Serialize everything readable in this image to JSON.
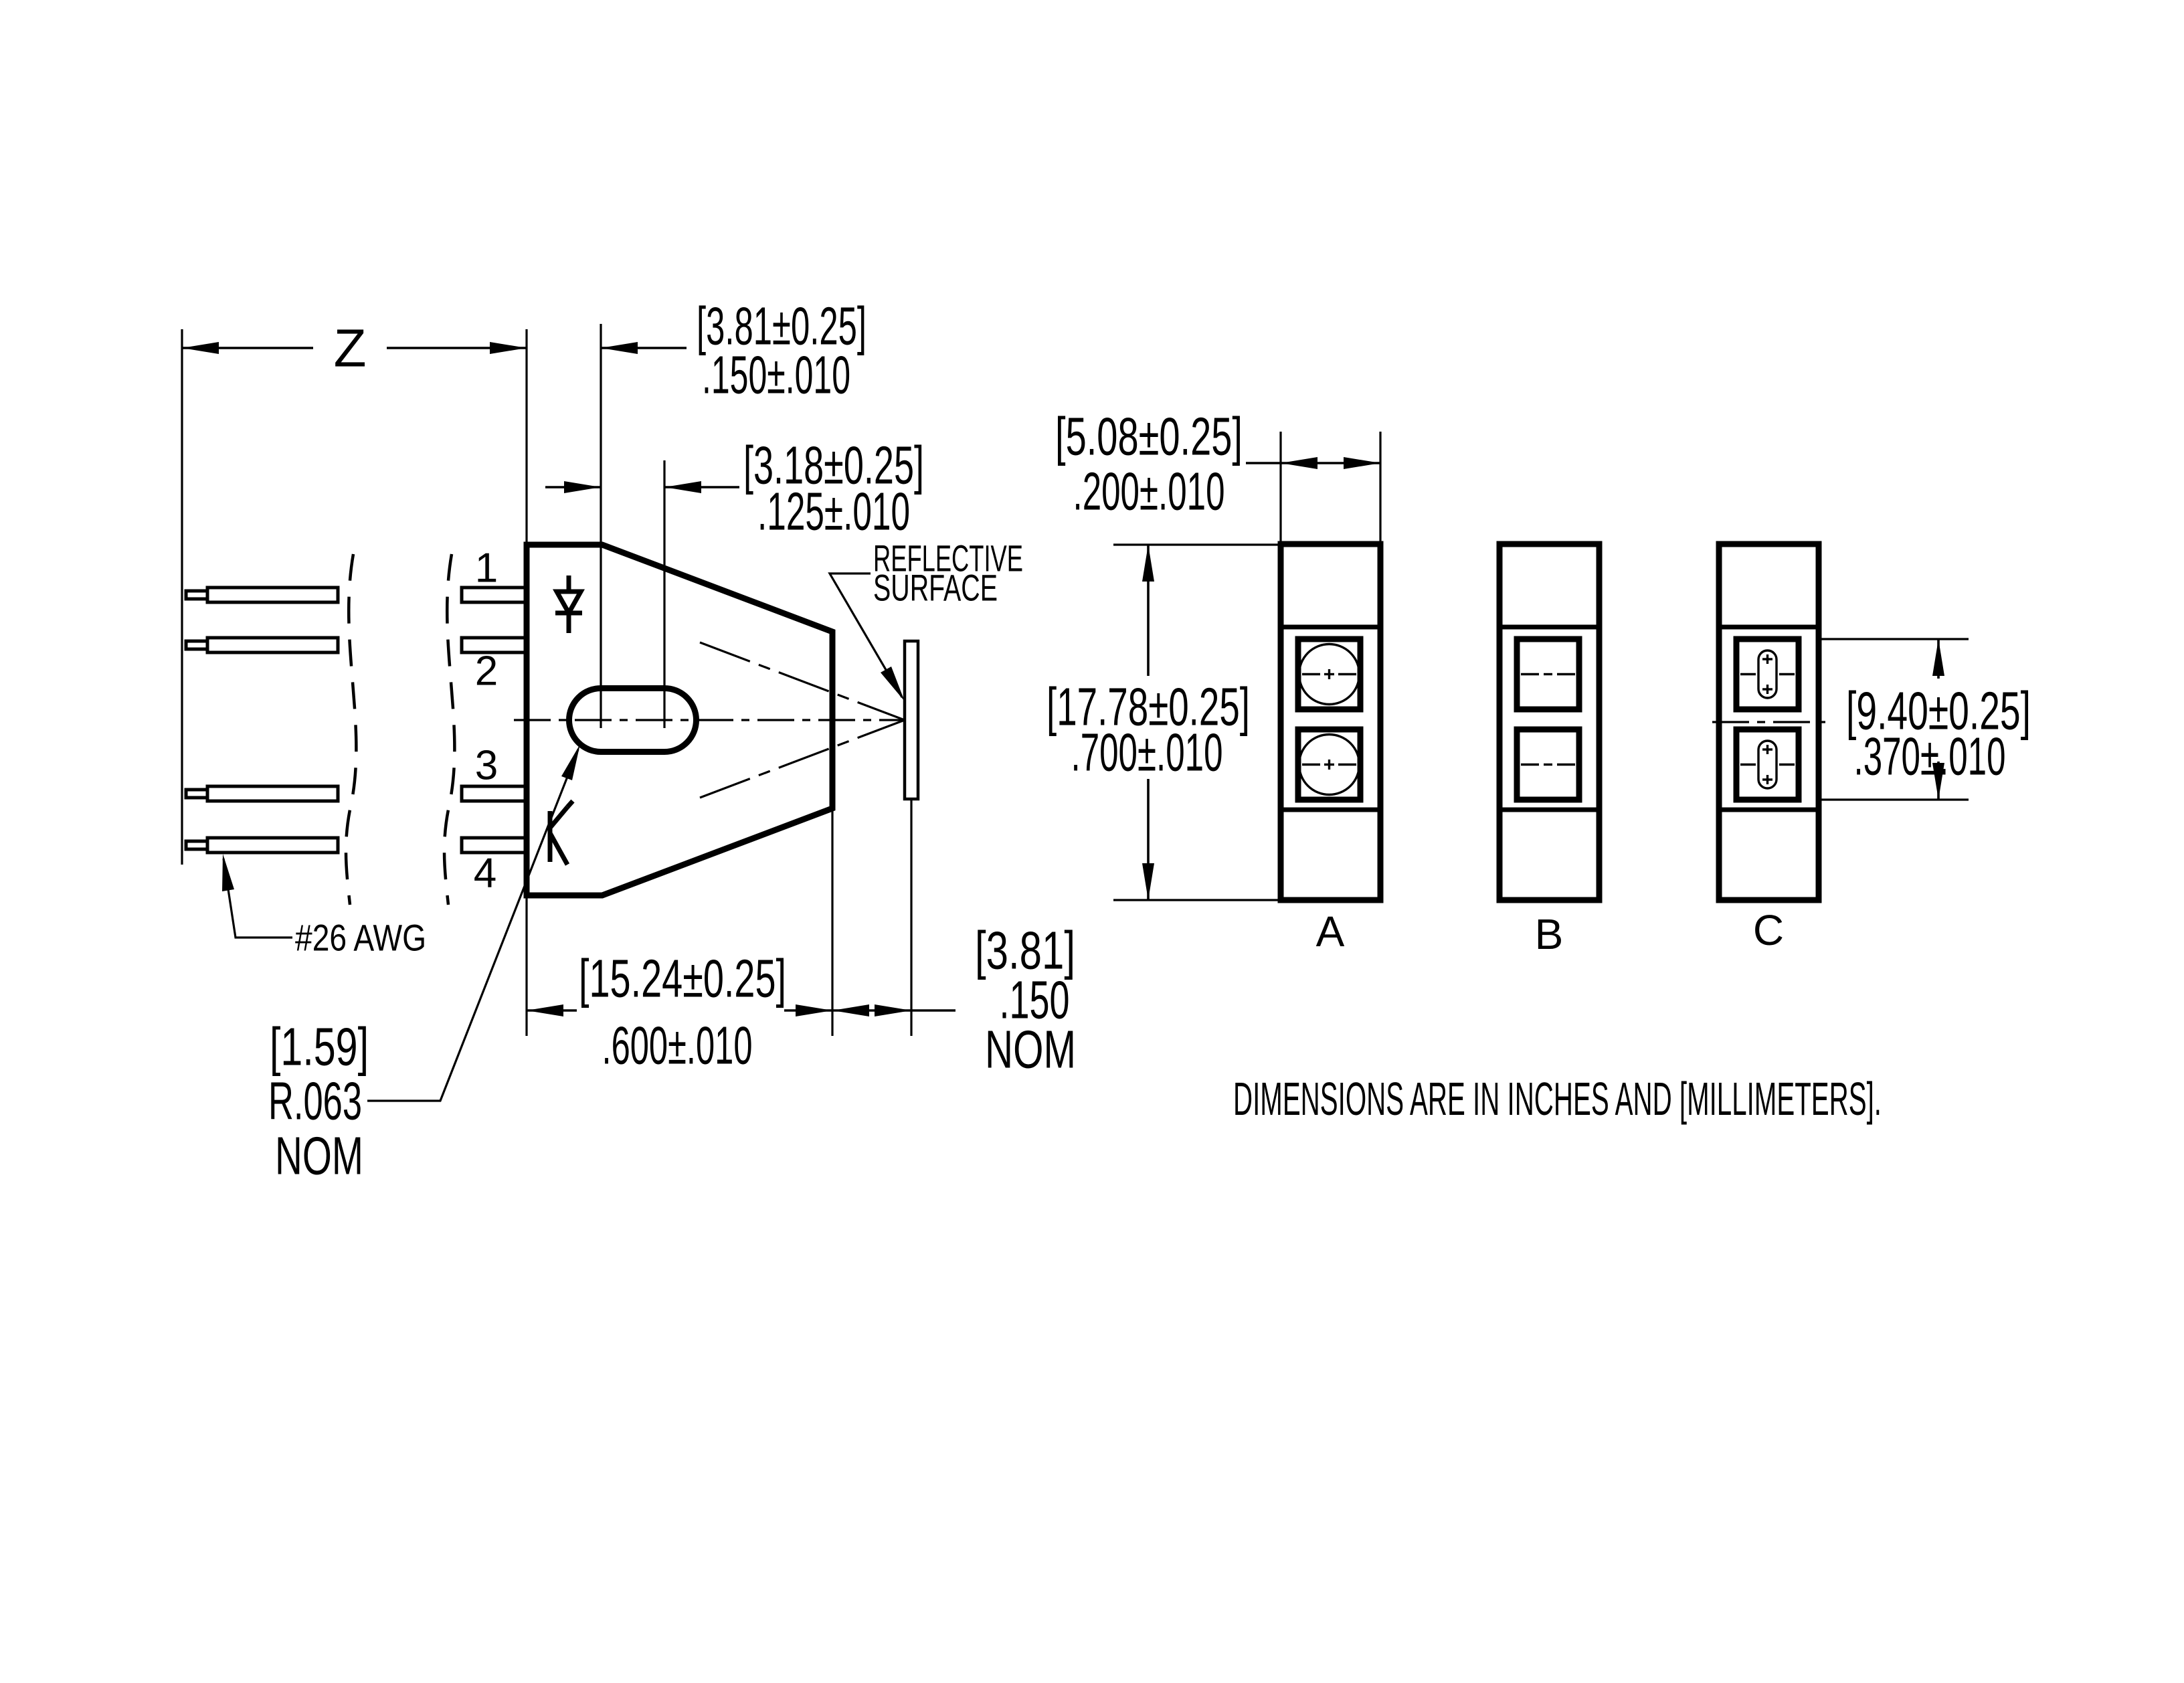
{
  "document": {
    "units_note": "DIMENSIONS ARE IN INCHES AND [MILLIMETERS]."
  },
  "side_view": {
    "pin_labels": [
      "1",
      "2",
      "3",
      "4"
    ],
    "wire_gauge_label": "#26 AWG",
    "reflective_surface": {
      "line1": "REFLECTIVE",
      "line2": "SURFACE"
    },
    "dims": {
      "lead_length": {
        "label": "Z"
      },
      "slot_offset": {
        "mm": "[3.81±0.25]",
        "in": ".150±.010"
      },
      "slot_length": {
        "mm": "[3.18±0.25]",
        "in": ".125±.010"
      },
      "body_width": {
        "mm": "[15.24±0.25]",
        "in": ".600±.010"
      },
      "focal_distance": {
        "mm": "[3.81]",
        "in": ".150",
        "qualifier": "NOM"
      },
      "slot_radius": {
        "mm": "[1.59]",
        "in": "R.063",
        "qualifier": "NOM"
      }
    }
  },
  "front_views": {
    "labels": {
      "a": "A",
      "b": "B",
      "c": "C"
    },
    "dims": {
      "width": {
        "mm": "[5.08±0.25]",
        "in": ".200±.010"
      },
      "height": {
        "mm": "[17.78±0.25]",
        "in": ".700±.010"
      },
      "aperture_span": {
        "mm": "[9.40±0.25]",
        "in": ".370±.010"
      }
    }
  }
}
